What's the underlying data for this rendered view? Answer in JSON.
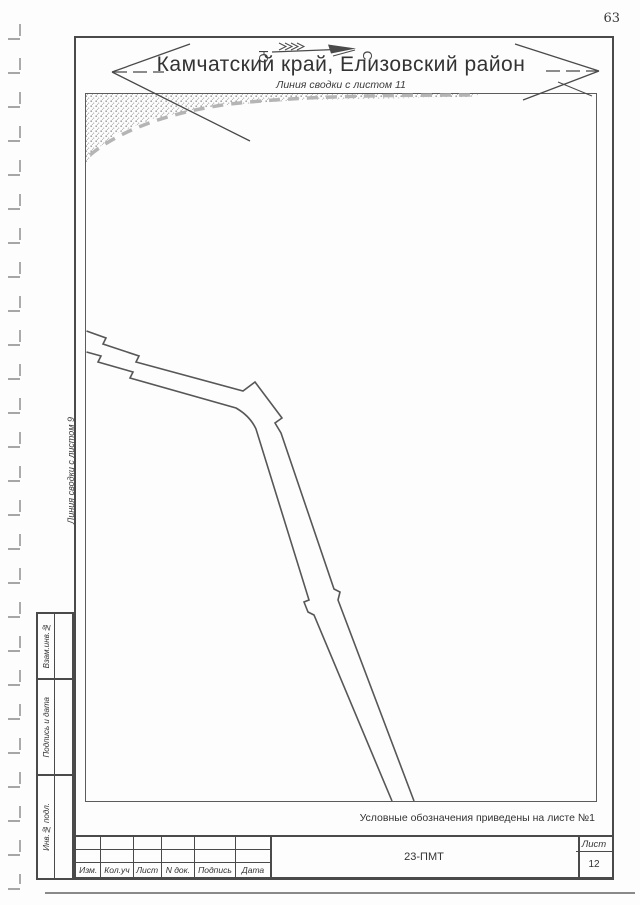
{
  "page": {
    "number": "63"
  },
  "header": {
    "title": "Камчатский край, Елизовский район",
    "match_line_top": "Линия сводки с листом 11",
    "compass": {
      "south": "Ю",
      "north": "С"
    }
  },
  "map": {
    "match_line_left": "Линия сводки с листом 9",
    "note": "Условные обозначения приведены на листе №1"
  },
  "sidebar": {
    "items": [
      {
        "label": "Взам.инв.№"
      },
      {
        "label": "Подпись и дата"
      },
      {
        "label": "Инв.№ подл."
      }
    ]
  },
  "title_block": {
    "columns": [
      "Изм.",
      "Кол.уч",
      "Лист",
      "N док.",
      "Подпись",
      "Дата"
    ],
    "document_number": "23-ПМТ",
    "sheet_label": "Лист",
    "sheet_number": "12"
  },
  "colors": {
    "line": "#4a4a4a",
    "road_line": "#575757",
    "stipple_dot": "#a3a3a3",
    "match_dash": "#b5b5b5"
  }
}
